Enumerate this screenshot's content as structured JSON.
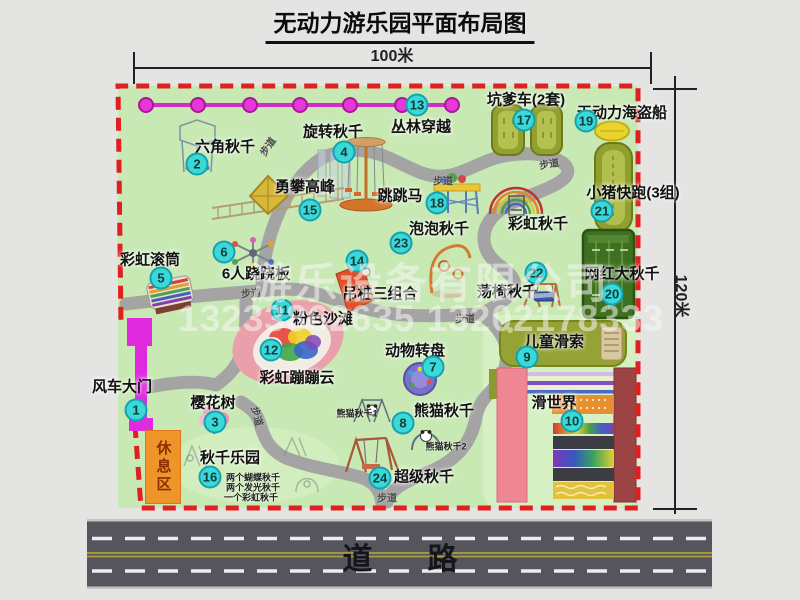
{
  "title": "无动力游乐园平面布局图",
  "dimensions": {
    "width": "100米",
    "height": "120米"
  },
  "road": {
    "label": "道路"
  },
  "watermark": {
    "company": "游乐设备有限公司",
    "phone": "13233862635 13202178333"
  },
  "legend": {
    "trail": "步道",
    "rest_area": "休息区"
  },
  "colors": {
    "park_green": "#c8e9b4",
    "border_red": "#e02020",
    "badge_cyan": "#3bd8d8",
    "path_gray": "#a4a4a4",
    "gate_magenta": "#e02ae0",
    "zipline_magenta": "#d42cc6",
    "road_gray": "#55555d",
    "rest_orange": "#ef9428"
  },
  "labels": [
    {
      "num": "1",
      "text": "风车大门",
      "tx": 122,
      "ty": 386,
      "bx": 136,
      "by": 410
    },
    {
      "num": "2",
      "text": "六角秋千",
      "tx": 225,
      "ty": 146,
      "bx": 197,
      "by": 164
    },
    {
      "num": "3",
      "text": "樱花树",
      "tx": 213,
      "ty": 402,
      "bx": 215,
      "by": 422
    },
    {
      "num": "4",
      "text": "旋转秋千",
      "tx": 333,
      "ty": 131,
      "bx": 344,
      "by": 152
    },
    {
      "num": "5",
      "text": "彩虹滚筒",
      "tx": 150,
      "ty": 259,
      "bx": 161,
      "by": 278
    },
    {
      "num": "6",
      "text": "6人跷跷板",
      "tx": 256,
      "ty": 273,
      "bx": 224,
      "by": 252
    },
    {
      "num": "7",
      "text": "动物转盘",
      "tx": 415,
      "ty": 350,
      "bx": 433,
      "by": 367
    },
    {
      "num": "8",
      "text": "熊猫秋千",
      "tx": 444,
      "ty": 410,
      "bx": 403,
      "by": 423
    },
    {
      "num": "9",
      "text": "儿童滑索",
      "tx": 554,
      "ty": 341,
      "bx": 527,
      "by": 357
    },
    {
      "num": "10",
      "text": "滑世界",
      "tx": 554,
      "ty": 402,
      "bx": 572,
      "by": 421
    },
    {
      "num": "11",
      "text": "粉色沙滩",
      "tx": 323,
      "ty": 318,
      "bx": 282,
      "by": 310
    },
    {
      "num": "12",
      "text": "彩虹蹦蹦云",
      "tx": 297,
      "ty": 377,
      "bx": 271,
      "by": 350
    },
    {
      "num": "13",
      "text": "丛林穿越",
      "tx": 421,
      "ty": 126,
      "bx": 417,
      "by": 105
    },
    {
      "num": "14",
      "text": "吊桩三组合",
      "tx": 380,
      "ty": 293,
      "bx": 357,
      "by": 261
    },
    {
      "num": "15",
      "text": "勇攀高峰",
      "tx": 305,
      "ty": 186,
      "bx": 310,
      "by": 210
    },
    {
      "num": "16",
      "text": "秋千乐园",
      "tx": 230,
      "ty": 457,
      "bx": 210,
      "by": 477
    },
    {
      "num": "17",
      "text": "坑爹车(2套)",
      "tx": 526,
      "ty": 99,
      "bx": 524,
      "by": 120
    },
    {
      "num": "18",
      "text": "跳跳马",
      "tx": 400,
      "ty": 195,
      "bx": 437,
      "by": 203
    },
    {
      "num": "19",
      "text": "无动力海盗船",
      "tx": 622,
      "ty": 112,
      "bx": 586,
      "by": 121
    },
    {
      "num": "20",
      "text": "网红大秋千",
      "tx": 622,
      "ty": 273,
      "bx": 612,
      "by": 294
    },
    {
      "num": "21",
      "text": "小猪快跑(3组)",
      "tx": 633,
      "ty": 192,
      "bx": 602,
      "by": 211
    },
    {
      "num": "22",
      "text": "荡椅秋千",
      "tx": 507,
      "ty": 291,
      "bx": 536,
      "by": 273
    },
    {
      "num": "23",
      "text": "泡泡秋千",
      "tx": 439,
      "ty": 228,
      "bx": 401,
      "by": 243
    },
    {
      "num": "24",
      "text": "超级秋千",
      "tx": 424,
      "ty": 476,
      "bx": 380,
      "by": 478
    },
    {
      "num": null,
      "text": "彩虹秋千",
      "tx": 538,
      "ty": 223,
      "bx": null,
      "by": null
    }
  ],
  "sub_labels": [
    {
      "text": "熊猫秋千1",
      "x": 357,
      "y": 413
    },
    {
      "text": "熊猫秋千2",
      "x": 446,
      "y": 446
    },
    {
      "text": "两个蝴蝶秋千",
      "x": 253,
      "y": 477
    },
    {
      "text": "两个发光秋千",
      "x": 253,
      "y": 487
    },
    {
      "text": "一个彩虹秋千",
      "x": 251,
      "y": 497
    }
  ],
  "trail_labels": [
    {
      "x": 267,
      "y": 146,
      "r": -55
    },
    {
      "x": 251,
      "y": 292,
      "r": -5
    },
    {
      "x": 443,
      "y": 180,
      "r": 0
    },
    {
      "x": 549,
      "y": 163,
      "r": -10
    },
    {
      "x": 465,
      "y": 318,
      "r": 0
    },
    {
      "x": 258,
      "y": 416,
      "r": 75
    },
    {
      "x": 387,
      "y": 497,
      "r": 0
    }
  ]
}
